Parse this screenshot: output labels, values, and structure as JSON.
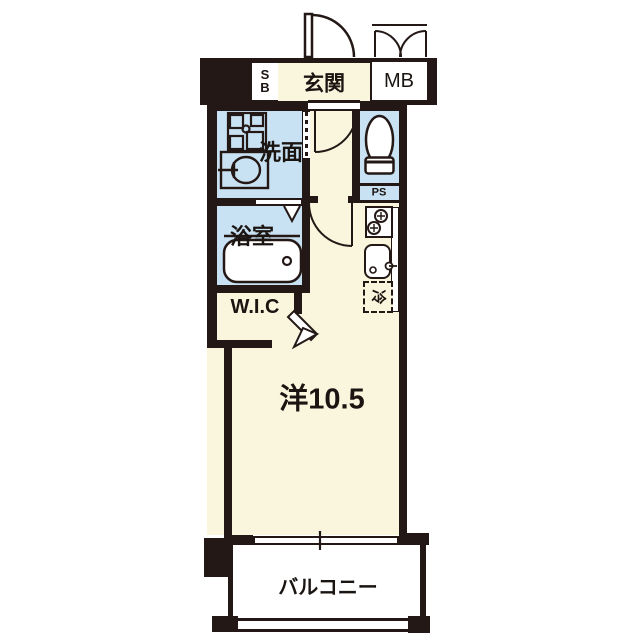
{
  "plan": {
    "labels": {
      "shoe_box_line1": "S",
      "shoe_box_line2": "B",
      "entrance": "玄関",
      "meter_box": "MB",
      "washroom": "洗面",
      "pipe_space": "PS",
      "bathroom": "浴室",
      "closet": "W.I.C",
      "main_room": "洋10.5",
      "balcony": "バルコニー",
      "refrigerator": "冷"
    },
    "colors": {
      "wall": "#231815",
      "floor_cream": "#FAF6DE",
      "wet_area_blue": "#C9E2F3",
      "white": "#FFFFFF"
    }
  }
}
